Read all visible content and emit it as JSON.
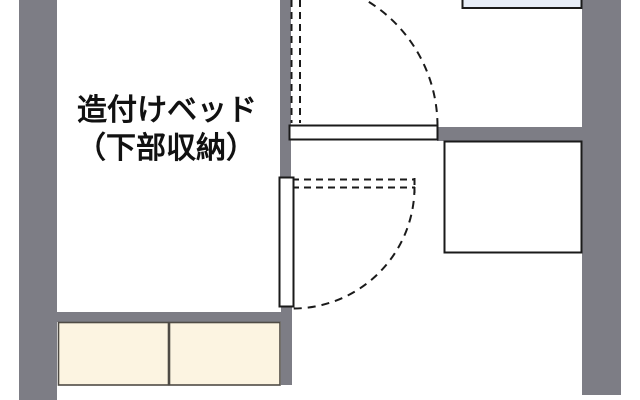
{
  "floorplan": {
    "bed_label": {
      "line1": "造付けベッド",
      "line2": "（下部収納）"
    },
    "colors": {
      "background": "#ffffff",
      "wall": "#7d7d85",
      "line": "#1a1a1a",
      "door_fill": "#ffffff",
      "bed_fill": "#fcf4e1",
      "bed_outline": "#4f4b45",
      "window_fill": "#e7edf7",
      "fixture_fill": "#ffffff",
      "text": "#111111"
    }
  }
}
